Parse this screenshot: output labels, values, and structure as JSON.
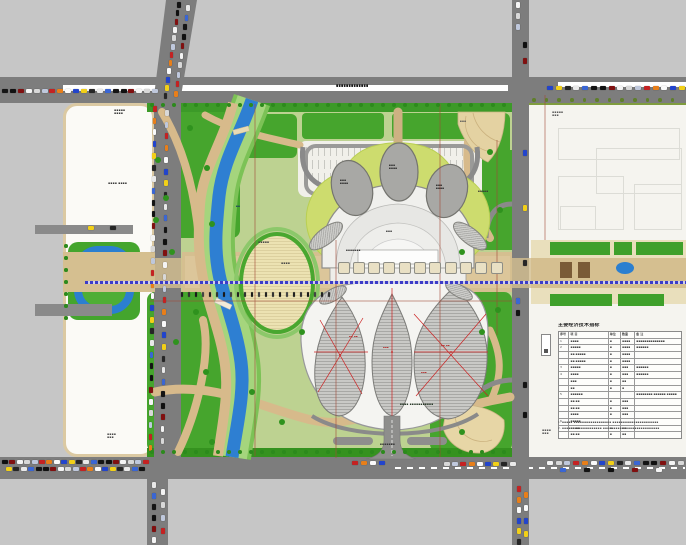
{
  "drawing": {
    "type_label": "site master plan",
    "road_name_label": "▪▪▪▪▪▪▪▪▪▪▪▪▪",
    "axis_color": "#3c3cc8",
    "water_color": "#2e7fd2",
    "green_color": "#46a52d",
    "plaza_color": "#d5bf90",
    "road_color": "#7d7d7d"
  },
  "legend": {
    "title": "主要经济技术指标",
    "headers": [
      "序号",
      "项 目",
      "单位",
      "数量",
      "备 注"
    ],
    "rows": [
      [
        "1",
        "▪▪▪▪",
        "▪",
        "▪▪▪▪",
        "▪▪▪▪▪▪▪▪▪▪▪▪▪▪"
      ],
      [
        "2",
        "▪▪▪▪▪",
        "▪",
        "▪▪▪▪",
        "▪▪▪▪▪▪"
      ],
      [
        "",
        "▪▪·▪▪▪▪▪",
        "▪",
        "▪▪▪▪",
        ""
      ],
      [
        "",
        "▪▪·▪▪▪▪▪",
        "▪",
        "▪▪▪▪",
        ""
      ],
      [
        "3",
        "▪▪▪▪▪",
        "▪",
        "▪▪▪",
        "▪▪▪▪▪▪"
      ],
      [
        "4",
        "▪▪▪▪",
        "▪",
        "▪▪▪",
        "▪▪▪▪▪▪"
      ],
      [
        "",
        "▪▪▪",
        "▪",
        "▪▪",
        ""
      ],
      [
        "",
        "▪▪",
        "▪",
        "▪",
        ""
      ],
      [
        "5",
        "▪▪▪▪▪▪",
        "",
        "",
        "▪▪▪▪▪▪▪▪ ▪▪▪▪▪▪ ▪▪▪▪▪"
      ],
      [
        "",
        "▪▪·▪▪",
        "▪",
        "▪▪▪",
        ""
      ],
      [
        "",
        "▪▪·▪▪",
        "▪",
        "▪▪▪",
        ""
      ],
      [
        "",
        "▪▪▪▪",
        "▪",
        "▪▪▪",
        ""
      ],
      [
        "6",
        "▪▪▪▪▪",
        "",
        "",
        ""
      ],
      [
        "",
        "▪▪·▪▪",
        "▪",
        "▪▪",
        ""
      ],
      [
        "",
        "▪▪·▪▪",
        "▪",
        "▪▪",
        ""
      ]
    ],
    "notes": [
      "1. ▪▪▪▪▪ ▪▪▪▪▪▪▪▪▪▪▪▪▪▪▪▪▪▪ ▪▪▪▪▪▪▪▪▪▪▪▪▪▪▪▪▪▪▪▪▪▪",
      "2. ▪▪▪▪▪▪▪▪▪▪▪▪▪▪▪▪▪▪▪ ▪▪▪▪▪▪▪▪▪▪▪▪▪▪▪▪▪▪▪▪▪▪▪▪▪▪▪"
    ]
  },
  "labels": [
    {
      "x": 114,
      "y": 109,
      "w": 28,
      "fs": 3,
      "c": "#333",
      "t": "▪▪▪▪▪\n▪▪▪▪"
    },
    {
      "x": 108,
      "y": 182,
      "w": 34,
      "fs": 3,
      "c": "#333",
      "t": "▪▪▪▪ ▪▪▪▪"
    },
    {
      "x": 336,
      "y": 84,
      "w": 92,
      "fs": 3.4,
      "c": "#1a1a1a",
      "t": "▪▪▪▪▪▪▪▪▪▪▪▪▪"
    },
    {
      "x": 258,
      "y": 241,
      "w": 30,
      "fs": 3,
      "c": "#444",
      "t": "▪▪▪▪▪"
    },
    {
      "x": 281,
      "y": 262,
      "w": 26,
      "fs": 3,
      "c": "#444",
      "t": "▪▪▪▪"
    },
    {
      "x": 340,
      "y": 179,
      "w": 24,
      "fs": 2.8,
      "c": "#222",
      "t": "▪▪▪\n▪▪▪▪"
    },
    {
      "x": 389,
      "y": 164,
      "w": 22,
      "fs": 2.8,
      "c": "#222",
      "t": "▪▪▪\n▪▪▪▪"
    },
    {
      "x": 436,
      "y": 184,
      "w": 24,
      "fs": 2.8,
      "c": "#222",
      "t": "▪▪▪\n▪▪▪▪"
    },
    {
      "x": 386,
      "y": 230,
      "w": 24,
      "fs": 2.8,
      "c": "#333",
      "t": "▪▪▪"
    },
    {
      "x": 346,
      "y": 249,
      "w": 46,
      "fs": 2.8,
      "c": "#333",
      "t": "▪▪▪▪▪▪▪"
    },
    {
      "x": 478,
      "y": 190,
      "w": 28,
      "fs": 2.8,
      "c": "#333",
      "t": "▪▪▪▪▪"
    },
    {
      "x": 400,
      "y": 403,
      "w": 84,
      "fs": 2.9,
      "c": "#223322",
      "t": "▪▪▪▪ ▪▪▪▪▪▪▪▪▪▪▪"
    },
    {
      "x": 380,
      "y": 443,
      "w": 44,
      "fs": 2.9,
      "c": "#333",
      "t": "▪▪▪▪▪▪▪"
    },
    {
      "x": 552,
      "y": 111,
      "w": 24,
      "fs": 3,
      "c": "#555",
      "t": "▪▪▪▪▪\n▪▪▪"
    },
    {
      "x": 542,
      "y": 429,
      "w": 22,
      "fs": 3,
      "c": "#555",
      "t": "▪▪▪▪\n▪▪▪"
    },
    {
      "x": 107,
      "y": 433,
      "w": 26,
      "fs": 3,
      "c": "#444",
      "t": "▪▪▪▪\n▪▪▪"
    },
    {
      "x": 236,
      "y": 205,
      "w": 14,
      "fs": 2.8,
      "c": "#1a3a66",
      "t": "▪▪"
    },
    {
      "x": 460,
      "y": 120,
      "w": 20,
      "fs": 2.8,
      "c": "#555",
      "t": "▪▪▪"
    },
    {
      "x": 349,
      "y": 336,
      "w": 18,
      "fs": 2.6,
      "c": "#b22222",
      "t": "▪▪ ▪▪"
    },
    {
      "x": 383,
      "y": 347,
      "w": 18,
      "fs": 2.6,
      "c": "#b22222",
      "t": "▪▪▪"
    },
    {
      "x": 441,
      "y": 345,
      "w": 20,
      "fs": 2.6,
      "c": "#b22222",
      "t": "▪▪ ▪▪"
    },
    {
      "x": 421,
      "y": 372,
      "w": 20,
      "fs": 2.6,
      "c": "#b22222",
      "t": "▪▪▪"
    }
  ],
  "cars": {
    "colors": [
      "#141414",
      "#f4f4f4",
      "#c42222",
      "#2244cc",
      "#e9e9e9",
      "#101010",
      "#d8d8d8",
      "#e87f1a",
      "#f2d018",
      "#3a66d4",
      "#801010",
      "#bfc8dc",
      "#fafafa",
      "#262626"
    ],
    "dark_colors": [
      "#222",
      "#333",
      "#1a1a1a",
      "#444"
    ],
    "rows": [
      {
        "o": "h",
        "x": 2,
        "y": 89,
        "dx": 7.9,
        "dy": 0,
        "n": 20,
        "s": 0
      },
      {
        "o": "h",
        "x": 547,
        "y": 86,
        "dx": 8.8,
        "dy": 0,
        "n": 16,
        "s": 3
      },
      {
        "o": "h",
        "x": 2,
        "y": 460,
        "dx": 7.4,
        "dy": 0,
        "n": 20,
        "s": 5
      },
      {
        "o": "h",
        "x": 6,
        "y": 467,
        "dx": 7.4,
        "dy": 0,
        "n": 19,
        "s": 8
      },
      {
        "o": "h",
        "x": 352,
        "y": 461,
        "dx": 9,
        "dy": 0,
        "n": 4,
        "s": 2
      },
      {
        "o": "h",
        "x": 444,
        "y": 462,
        "dx": 8.2,
        "dy": 0,
        "n": 9,
        "s": 6
      },
      {
        "o": "h",
        "x": 547,
        "y": 461,
        "dx": 8.7,
        "dy": 0,
        "n": 16,
        "s": 1
      },
      {
        "o": "h",
        "x": 560,
        "y": 468,
        "dx": 24,
        "dy": 0,
        "n": 5,
        "s": 9
      },
      {
        "o": "h",
        "x": 88,
        "y": 226,
        "dx": 22,
        "dy": 0,
        "n": 2,
        "s": 8
      },
      {
        "o": "v",
        "x": 177,
        "y": 2,
        "dx": -1.2,
        "dy": 8.3,
        "n": 12,
        "s": 0
      },
      {
        "o": "v",
        "x": 186,
        "y": 5,
        "dx": -1.3,
        "dy": 9.5,
        "n": 10,
        "s": 4
      },
      {
        "o": "v",
        "x": 153,
        "y": 106,
        "dx": -0.15,
        "dy": 11.7,
        "n": 30,
        "s": 2
      },
      {
        "o": "v",
        "x": 165,
        "y": 110,
        "dx": -0.15,
        "dy": 11.7,
        "n": 29,
        "s": 6
      },
      {
        "o": "v",
        "x": 516,
        "y": 2,
        "dx": 0,
        "dy": 11,
        "n": 3,
        "s": 1
      },
      {
        "o": "v",
        "x": 523,
        "y": 42,
        "dx": 0,
        "dy": 16,
        "n": 2,
        "s": 5
      },
      {
        "o": "v",
        "x": 523,
        "y": 150,
        "dx": 0,
        "dy": 55,
        "n": 3,
        "s": 3
      },
      {
        "o": "v",
        "x": 516,
        "y": 298,
        "dx": 0,
        "dy": 12,
        "n": 2,
        "s": 9
      },
      {
        "o": "v",
        "x": 523,
        "y": 382,
        "dx": 0,
        "dy": 30,
        "n": 2,
        "s": 0
      },
      {
        "o": "v",
        "x": 517,
        "y": 486,
        "dx": 0,
        "dy": 10.5,
        "n": 6,
        "s": 2
      },
      {
        "o": "v",
        "x": 524,
        "y": 492,
        "dx": 0,
        "dy": 13,
        "n": 4,
        "s": 7
      },
      {
        "o": "v",
        "x": 152,
        "y": 482,
        "dx": 0,
        "dy": 11,
        "n": 6,
        "s": 4
      },
      {
        "o": "v",
        "x": 161,
        "y": 489,
        "dx": 0,
        "dy": 13,
        "n": 4,
        "s": 1
      },
      {
        "o": "t",
        "x": 181,
        "y": 292,
        "dx": 7,
        "dy": 0,
        "n": 22,
        "s": 0
      }
    ]
  },
  "trees": {
    "rows": [
      {
        "x": 152,
        "y": 105,
        "dx": 11,
        "dy": 0,
        "n": 33,
        "r": 2.2,
        "c": "#2c8a1c"
      },
      {
        "x": 534,
        "y": 100,
        "dx": 12.6,
        "dy": 0,
        "n": 12,
        "r": 1.8,
        "c": "#5f7f2a"
      },
      {
        "x": 152,
        "y": 452,
        "dx": 11,
        "dy": 0,
        "n": 33,
        "r": 2.2,
        "c": "#2c8a1c"
      },
      {
        "x": 66,
        "y": 246,
        "dx": 0,
        "dy": 12,
        "n": 7,
        "r": 1.8,
        "c": "#2c8a1c"
      }
    ],
    "singles": [
      [
        190,
        128
      ],
      [
        207,
        168
      ],
      [
        166,
        198
      ],
      [
        212,
        224
      ],
      [
        172,
        252
      ],
      [
        196,
        312
      ],
      [
        176,
        342
      ],
      [
        206,
        372
      ],
      [
        252,
        392
      ],
      [
        282,
        422
      ],
      [
        462,
        252
      ],
      [
        490,
        152
      ],
      [
        302,
        332
      ],
      [
        482,
        332
      ],
      [
        212,
        442
      ],
      [
        462,
        432
      ],
      [
        156,
        220
      ],
      [
        158,
        160
      ],
      [
        500,
        210
      ],
      [
        498,
        310
      ]
    ],
    "single_color": "#2f921e"
  },
  "planters": {
    "x0": 337.5,
    "y": 262,
    "dx": 15.3,
    "n": 11,
    "size": 10
  }
}
